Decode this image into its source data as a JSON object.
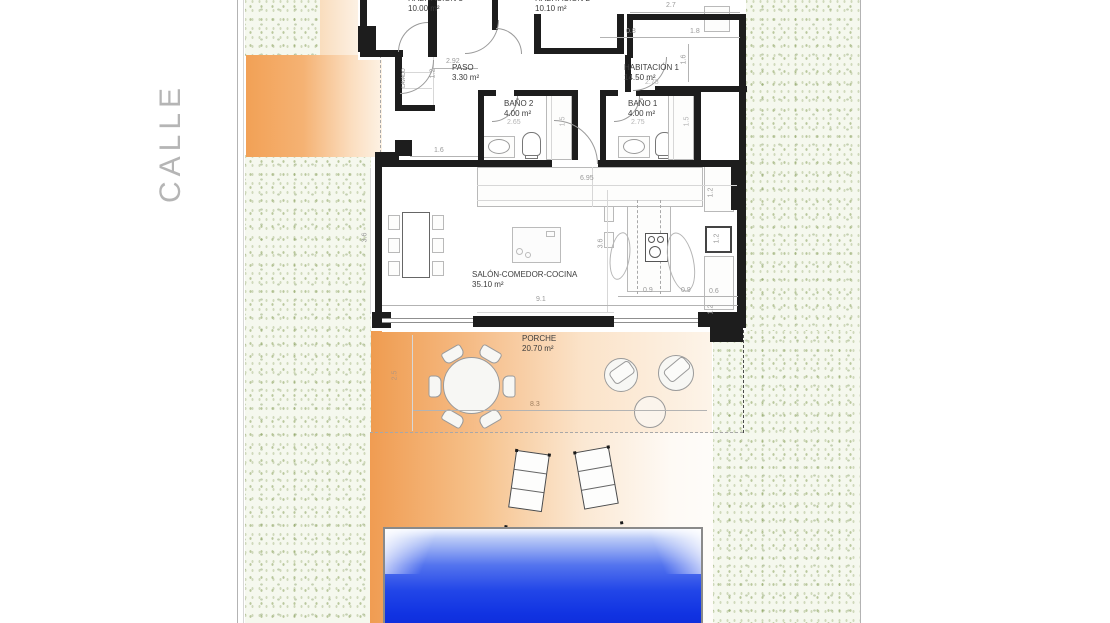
{
  "street_label": "CALLE",
  "rooms": {
    "hab3": {
      "name": "HABITACIÓN 3",
      "area": "10.00 m²"
    },
    "hab2": {
      "name": "HABITACIÓN 2",
      "area": "10.10 m²"
    },
    "paso": {
      "name": "PASO",
      "area": "3.30 m²"
    },
    "hab1": {
      "name": "HABITACIÓN 1",
      "area": "14.50 m²"
    },
    "bano2": {
      "name": "BAÑO 2",
      "area": "4.00 m²"
    },
    "bano1": {
      "name": "BAÑO 1",
      "area": "4.00 m²"
    },
    "salon": {
      "name": "SALÓN-COMEDOR-COCINA",
      "area": "35.10 m²"
    },
    "porche": {
      "name": "PORCHE",
      "area": "20.70 m²"
    },
    "lavado": {
      "name": "LAVADO"
    }
  },
  "dims": {
    "d27": "2.7",
    "d08": "0.8",
    "d18": "1.8",
    "d16v": "1.6",
    "d278": "2.78",
    "d292": "2.92",
    "d12paso": "1.2",
    "d16entry": "1.6",
    "d265": "2.65",
    "d275": "2.75",
    "d15a": "1.5",
    "d15b": "1.5",
    "d695": "6.95",
    "d36a": "3.6",
    "d36b": "3.6",
    "d91": "9.1",
    "d09a": "0.9",
    "d09b": "0.9",
    "d06": "0.6",
    "d12a": "1.2",
    "d12b": "1.2",
    "d12c": "1.2",
    "d83": "8.3",
    "d25": "2.5"
  },
  "colors": {
    "orange": "#f2a156",
    "wall": "#1d1d1d",
    "pool_deep": "#0c2ad7",
    "green_dots": "#a9bd8a",
    "dim_text": "#9a9a9a",
    "street_text": "#b5b5b5"
  }
}
